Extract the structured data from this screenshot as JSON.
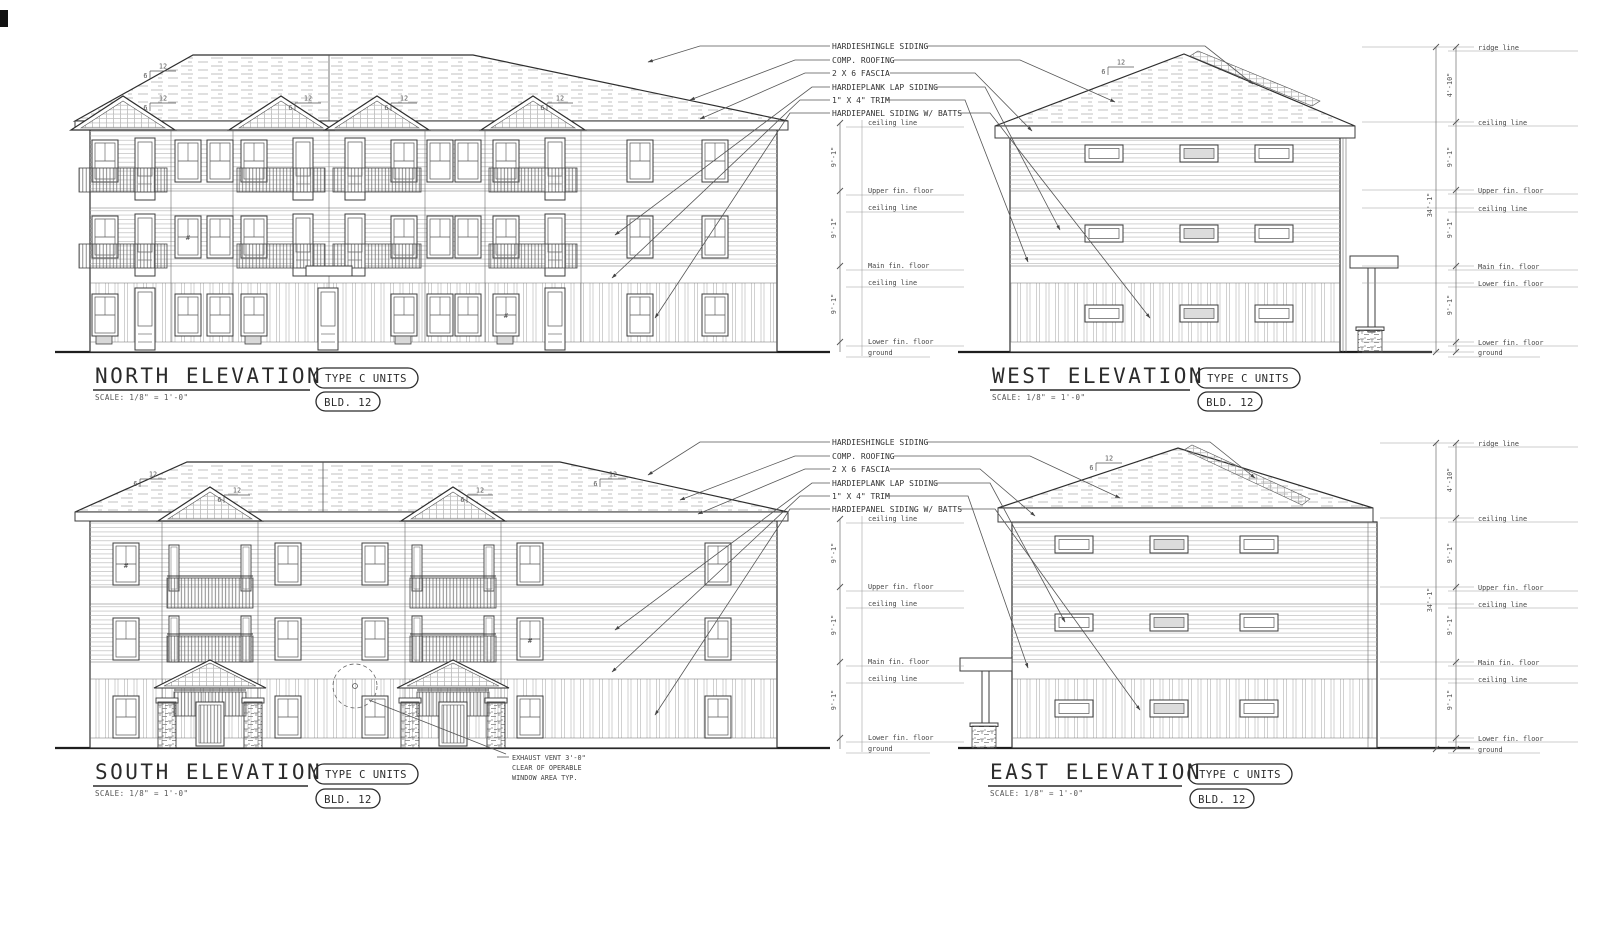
{
  "sheet": {
    "background": "#ffffff",
    "line_color": "#3c3c3c"
  },
  "titles": {
    "north": "NORTH ELEVATION",
    "west": "WEST ELEVATION",
    "south": "SOUTH ELEVATION",
    "east": "EAST ELEVATION",
    "scale": "SCALE: 1/8\" = 1'-0\"",
    "type_units": "TYPE C UNITS",
    "bld": "BLD. 12"
  },
  "callouts": [
    "HARDIESHINGLE SIDING",
    "COMP. ROOFING",
    "2 X 6 FASCIA",
    "HARDIEPLANK LAP SIDING",
    "1\" X 4\" TRIM",
    "HARDIEPANEL SIDING W/ BATTS"
  ],
  "levels": {
    "ridge": "ridge line",
    "ceiling": "ceiling line",
    "upper": "Upper fin. floor",
    "main": "Main fin. floor",
    "lower": "Lower fin. floor",
    "ground": "ground"
  },
  "dimensions": {
    "floor_height": "9'-1\"",
    "attic_height": "4'-10\"",
    "overall_height": "34'-1\""
  },
  "roof_slope": {
    "run": "12",
    "rise": "6"
  },
  "notes": {
    "exhaust_line1": "EXHAUST VENT 3'-0\"",
    "exhaust_line2": "CLEAR OF OPERABLE",
    "exhaust_line3": "WINDOW AREA TYP."
  },
  "window_mark": "#"
}
